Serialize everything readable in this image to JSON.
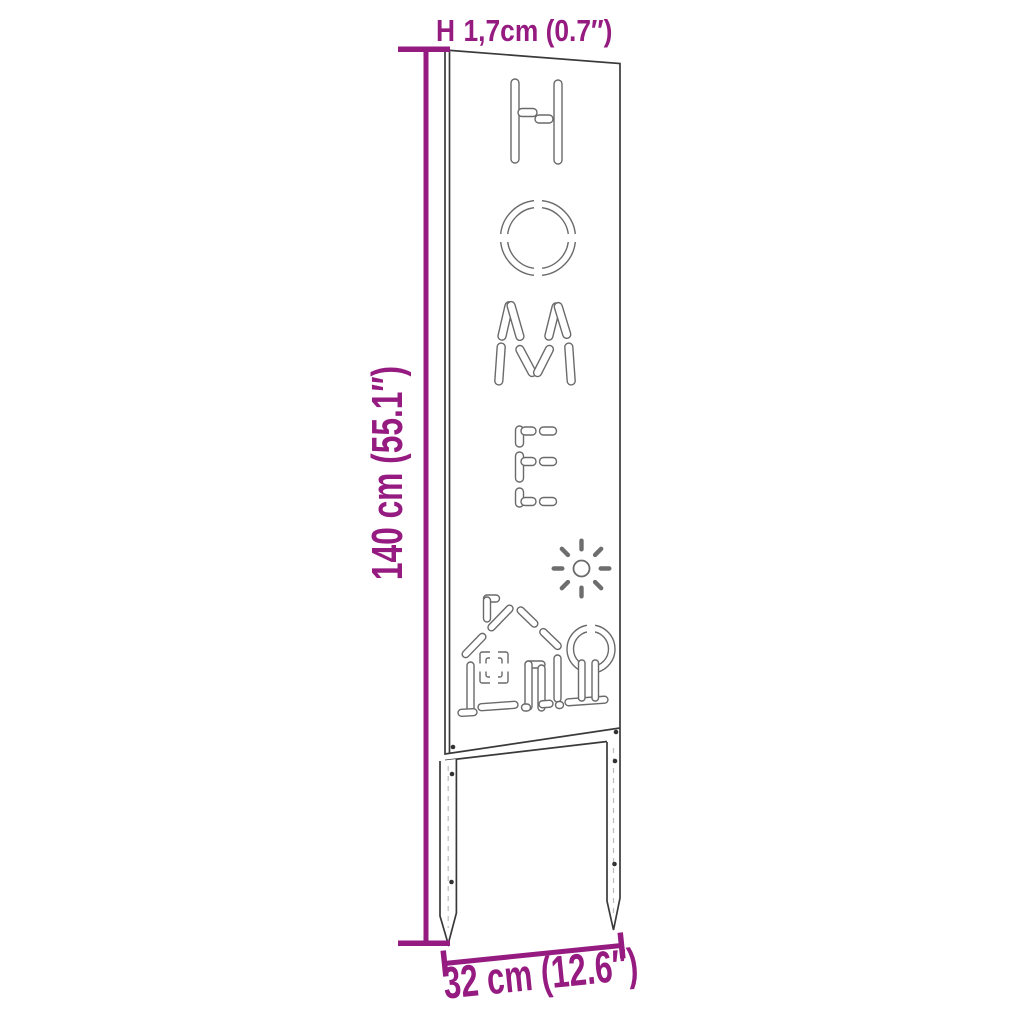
{
  "title": "Garden sign stake dimension diagram",
  "panel": {
    "cutout_word": "HOME",
    "letters": [
      "H",
      "O",
      "M",
      "E"
    ],
    "motifs": [
      "house",
      "sun",
      "tree"
    ]
  },
  "dimensions": {
    "thickness": {
      "symbol": "H",
      "value": "1,7cm (0.7″)"
    },
    "height": {
      "value": "140 cm (55.1″)"
    },
    "width": {
      "value": "32 cm (12.6″)"
    }
  },
  "colors": {
    "dimension_annotation": "#951b81",
    "panel_outline": "#3a3a3a",
    "artwork_line": "#6a6a6a",
    "background": "#ffffff"
  },
  "icons": [
    "house-icon",
    "sun-icon",
    "tree-icon",
    "thickness-marker-icon"
  ]
}
